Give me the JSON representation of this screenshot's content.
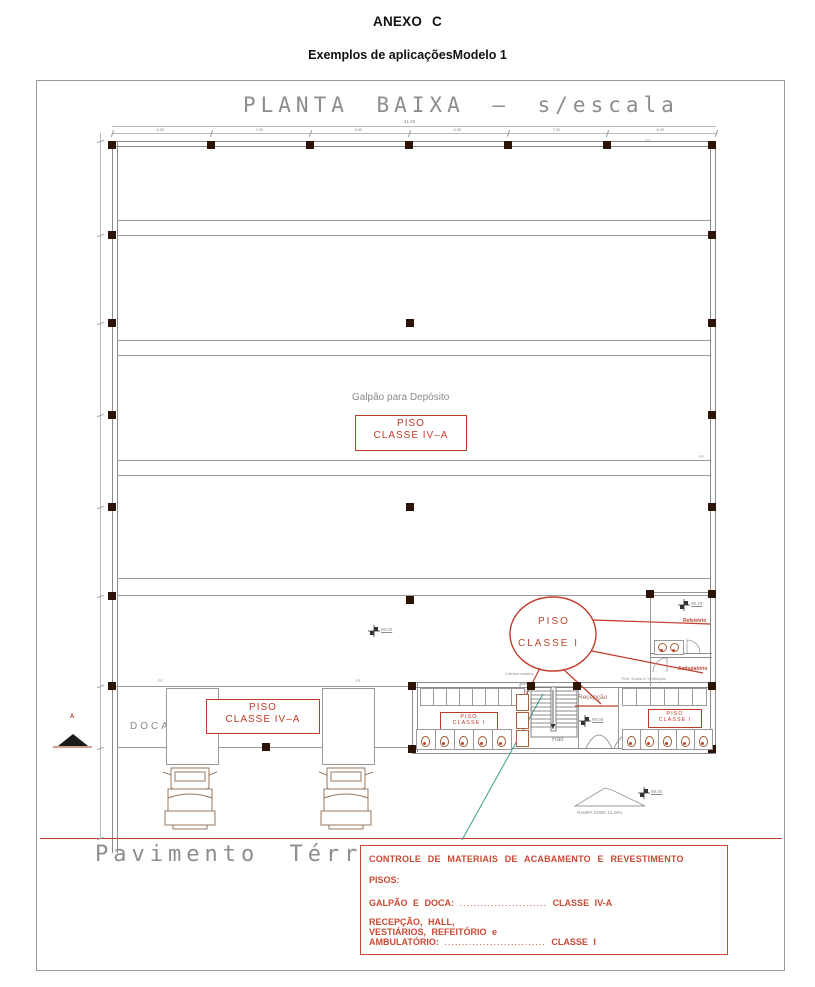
{
  "page": {
    "title": "ANEXO C",
    "subtitle": "Exemplos de aplicaçõesModelo 1"
  },
  "drawing": {
    "title": "PLANTA BAIXA — s/escala",
    "floor_label": "Pavimento Térreo",
    "shed_label": "Galpão para Depósito",
    "doca_label": "DOCA",
    "ramp_label": "RAMPA SOBE 11,34%",
    "turnstile_label": "Catraca rotativa",
    "vent_label": "Port. Dupla c/ Ventilação",
    "section_marker": "A",
    "column_labels": {
      "p1": "P1",
      "p2": "P2",
      "p3": "P3"
    },
    "rooms": {
      "refeitorio": "Refeitório",
      "ambulatorio": "Ambulatório",
      "vestiario_left": "Vestiário",
      "vestiario_right": "Vestiário",
      "recepcao": "Recepção",
      "hall": "Hall"
    },
    "levels": {
      "shed": "98.00",
      "refeitorio": "98.10",
      "hall": "98.00",
      "ramp": "98.00"
    },
    "tags": {
      "shed_class": {
        "l1": "PISO",
        "l2": "CLASSE IV–A"
      },
      "doca_class": {
        "l1": "PISO",
        "l2": "CLASSE IV–A"
      },
      "ellipse": {
        "l1": "PISO",
        "l2": "CLASSE I"
      },
      "vest_left": {
        "l1": "PISO",
        "l2": "CLASSE I"
      },
      "vest_right": {
        "l1": "PISO",
        "l2": "CLASSE I"
      }
    },
    "dimensions": {
      "top_total": "41.60",
      "top_segments": [
        "6.90",
        "7.00",
        "6.90",
        "6.90",
        "7.00",
        "6.90"
      ]
    }
  },
  "legend": {
    "title": "CONTROLE DE MATERIAIS DE ACABAMENTO E REVESTIMENTO",
    "subtitle": "PISOS:",
    "rows": [
      {
        "label": "GALPÃO E DOCA:",
        "dots": ".........................",
        "value": "CLASSE IV-A"
      },
      {
        "label_lines": [
          "RECEPÇÃO, HALL,",
          "VESTIÁRIOS, REFEITÓRIO e",
          "AMBULATÓRIO:"
        ],
        "dots": ".............................",
        "value": "CLASSE I"
      }
    ]
  },
  "colors": {
    "red": "#c13b2a",
    "legend_red": "#c74a33",
    "line_gray": "#8c8c8c",
    "column_dark": "#2d1206",
    "green": "#3aa08a"
  }
}
